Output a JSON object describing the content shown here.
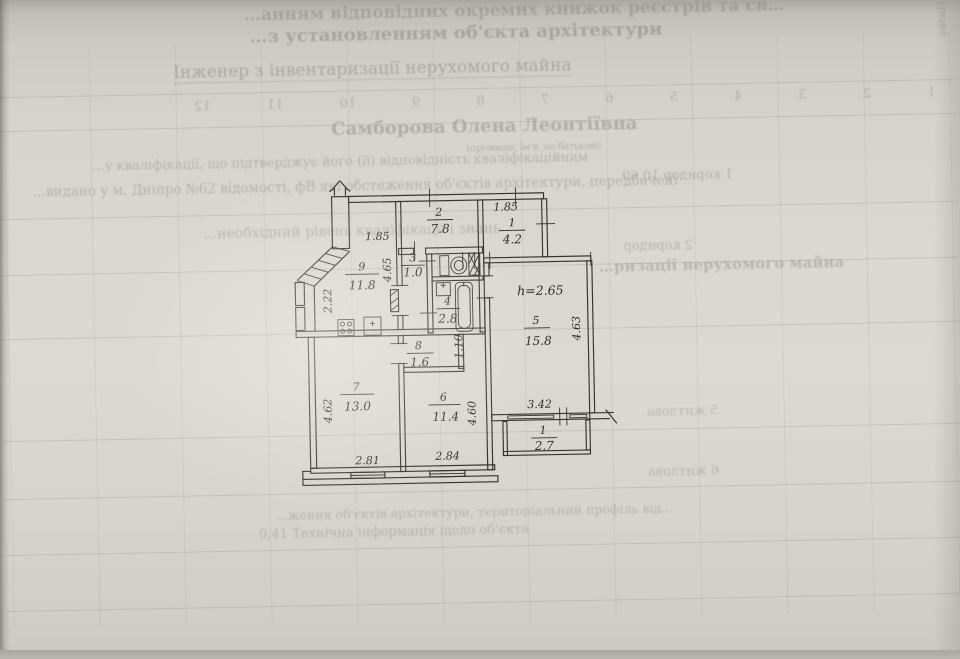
{
  "document": {
    "bleed": {
      "top_line_1": "…анням відповідних окремих книжок реєстрів та св…",
      "top_line_2": "…з установленням об'єкта архітектури",
      "engineer_title": "Інженер з інвентаризації нерухомого майна",
      "engineer_name": "Самборова Олена Леонтіївна",
      "name_note": "(прізвище, ім'я, по батькові)",
      "qual_line_1": "…у кваліфікації, що підтверджує його (її) відповідність кваліфікаційним",
      "qual_line_2": "…видано у м. Дніпро №62 відомості, фВ які обстеження об'єктів архітектури, передбачені",
      "qual_line_3": "…необхідний рівень кваліфікації і знань",
      "majna_fragment": "…ризації нерухомого майна",
      "column_numbers": "1 2 3 4 5 6 7 8 9 10 11 12",
      "nazva_vertical": "Назва",
      "row_koridor_1": "1  коридор  10,69",
      "row_koridor_2": "2  коридор",
      "row_zhytlova_5": "5  житлова",
      "row_zhytlova_6": "6  житлова",
      "bottom_line_1": "…ження об'єктів архітектури, територіальний профіль від…",
      "bottom_line_2": "0,41     Технічна інформація щодо об'єкта"
    }
  },
  "plan": {
    "rooms": {
      "r9": {
        "num": "9",
        "area": "11.8"
      },
      "r2": {
        "num": "2",
        "area": "7.8"
      },
      "r1t": {
        "num": "1",
        "area": "4.2"
      },
      "r3": {
        "num": "3",
        "area": "1.0"
      },
      "r4": {
        "num": "4",
        "area": "2.8"
      },
      "r5": {
        "num": "5",
        "area": "15.8"
      },
      "r8": {
        "num": "8",
        "area": "1.6"
      },
      "r7": {
        "num": "7",
        "area": "13.0"
      },
      "r6": {
        "num": "6",
        "area": "11.4"
      },
      "r1b": {
        "num": "1",
        "area": "2.7"
      }
    },
    "dims": {
      "top_left": "1.85",
      "top_right": "1.85",
      "kitchen_width": "2.22",
      "kitchen_height": "4.65",
      "ceiling": "h=2.65",
      "room5_height": "4.63",
      "closet": "1.10",
      "room7_height": "4.62",
      "room6_height": "4.60",
      "room7_width": "2.81",
      "room6_width": "2.84",
      "balcony_width": "3.42"
    }
  }
}
